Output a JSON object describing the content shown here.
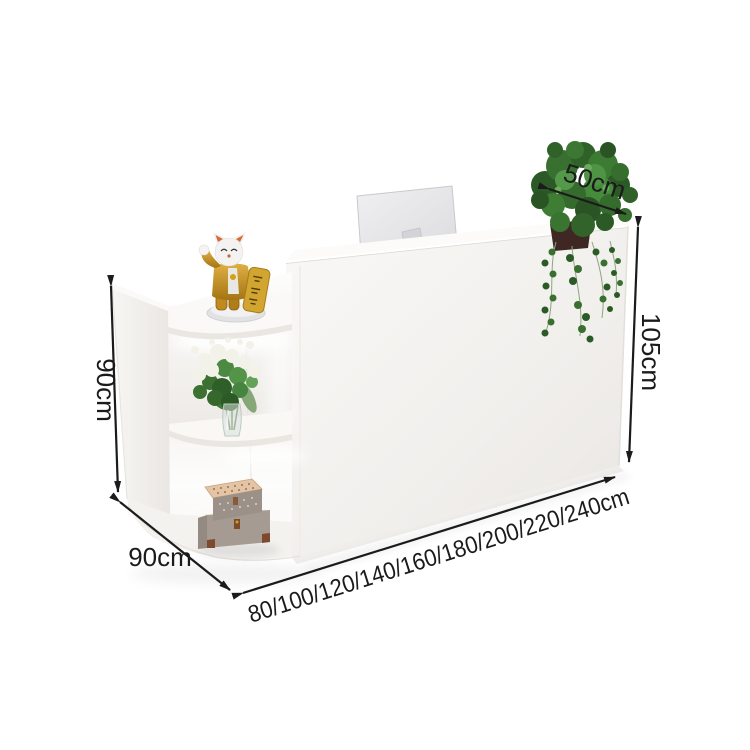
{
  "annotations": {
    "top_depth": "50cm",
    "counter_height": "105cm",
    "cabinet_height": "90cm",
    "cabinet_depth": "90cm",
    "width_options": "80/100/120/140/160/180/200/220/240cm"
  },
  "colors": {
    "background": "#ffffff",
    "annotation_ink": "#1b1b1b",
    "desk_white": "#f6f5f2",
    "desk_shadow": "#e8e5e1",
    "foliage_green": "#3a7031",
    "cat_gold": "#c9982e",
    "tablet_gold": "#d1a52f",
    "chest_leather_brown": "#7c4a2c",
    "pot_brown": "#3f2723"
  }
}
